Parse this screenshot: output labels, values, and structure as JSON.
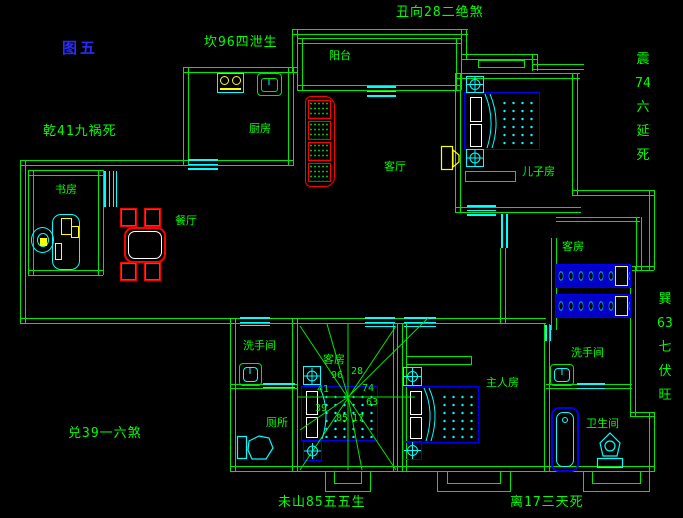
{
  "figure": {
    "label": "图五"
  },
  "annotations": {
    "top_left": "坎96四泄生",
    "top_center": "丑向28二绝煞",
    "left": "乾41九祸死",
    "bottom_left": "兑39一六煞",
    "bottom_center": "未山85五五生",
    "bottom_right": "离17三天死",
    "right_upper_vertical": [
      "震",
      "74",
      "六",
      "延",
      "死"
    ],
    "right_lower_vertical": [
      "巽",
      "63",
      "七",
      "伏",
      "旺"
    ]
  },
  "rooms": {
    "balcony": "阳台",
    "kitchen": "厨房",
    "study": "书房",
    "dining": "餐厅",
    "living": "客厅",
    "son": "儿子房",
    "guest_right": "客房",
    "guest_center": "客房",
    "master": "主人房",
    "washroom_a": "洗手间",
    "toilet": "厕所",
    "washroom_b": "洗手间",
    "bathroom": "卫生间"
  },
  "compass": {
    "nw": "96",
    "ne": "28",
    "w_upper": "41",
    "e_upper": "74",
    "w_lower": "39",
    "e_lower": "63",
    "sw": "85",
    "se": "17"
  },
  "colors": {
    "wall_green": "#00e800",
    "text_green": "#00ff00",
    "figure_blue": "#2a2aff",
    "furniture_blue": "#0000ee",
    "furniture_cyan": "#00ffff",
    "accent_yellow": "#ffff00",
    "accent_red": "#ff0000",
    "accent_magenta": "#ff00ff"
  }
}
